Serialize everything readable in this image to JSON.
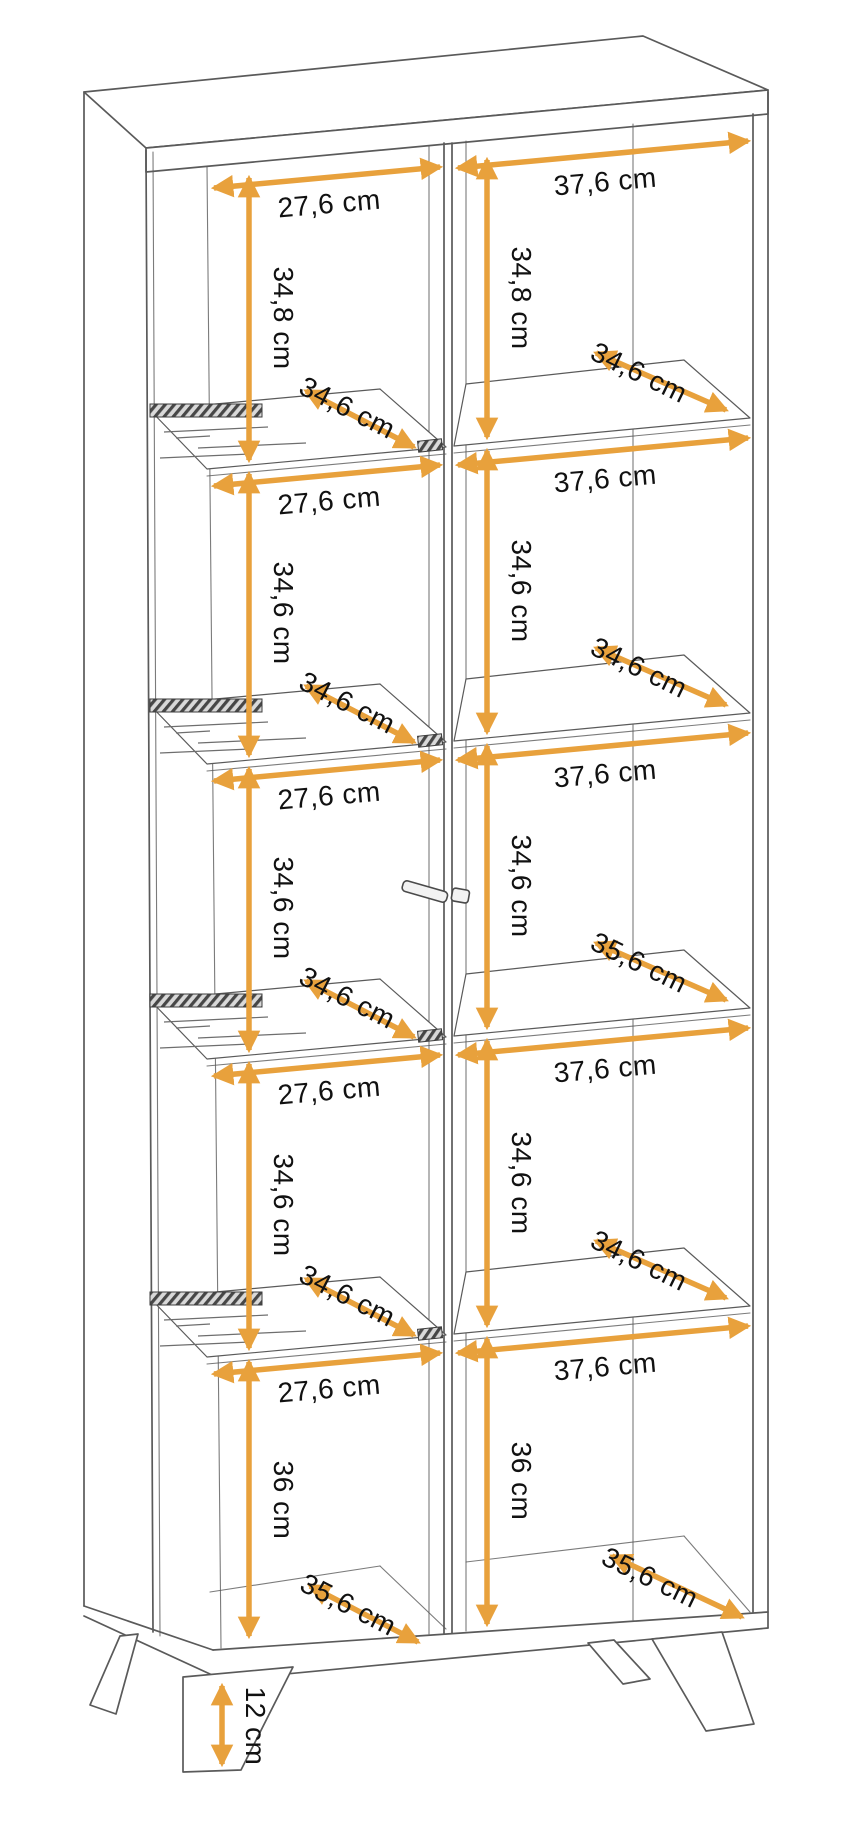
{
  "diagram": {
    "kind": "furniture-dimension-diagram",
    "subject": "tall two-column display cabinet with glass shelves, door handle and angled legs",
    "unit": "cm",
    "colors": {
      "arrow": "#E8A13C",
      "line": "#5A5A5A",
      "text": "#111111",
      "background": "#FFFFFF"
    }
  },
  "dims": {
    "left": {
      "widths": [
        "27,6 cm",
        "27,6 cm",
        "27,6 cm",
        "27,6 cm",
        "27,6 cm"
      ],
      "heights": [
        "34,8 cm",
        "34,6 cm",
        "34,6 cm",
        "34,6 cm",
        "36 cm"
      ],
      "shelf_depths": [
        "34,6 cm",
        "34,6 cm",
        "34,6 cm",
        "34,6 cm"
      ],
      "bottom_depth": "35,6 cm"
    },
    "right": {
      "widths": [
        "37,6 cm",
        "37,6 cm",
        "37,6 cm",
        "37,6 cm",
        "37,6 cm"
      ],
      "heights": [
        "34,8 cm",
        "34,6 cm",
        "34,6 cm",
        "34,6 cm",
        "36 cm"
      ],
      "shelf_depths": [
        "34,6 cm",
        "34,6 cm",
        "35,6 cm",
        "34,6 cm"
      ],
      "bottom_depth": "35,6 cm"
    },
    "legs_height": "12 cm"
  }
}
